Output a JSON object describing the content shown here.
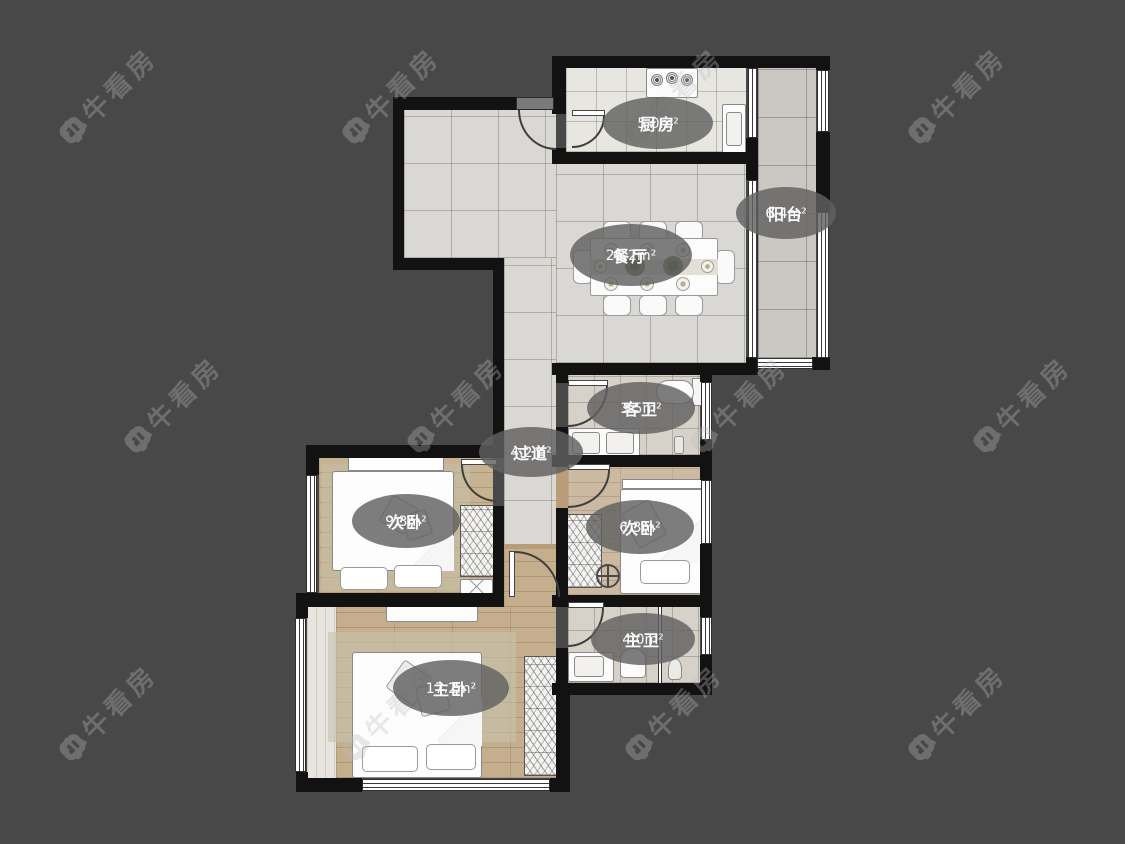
{
  "watermark": {
    "brand": "小牛看房",
    "star_icon": "✦"
  },
  "rooms": [
    {
      "id": "kitchen",
      "name": "厨房",
      "area": "5.0m²"
    },
    {
      "id": "balcony",
      "name": "阳台",
      "area": "6.4m²"
    },
    {
      "id": "dining",
      "name": "餐厅",
      "area": "25.2m²"
    },
    {
      "id": "guest-bath",
      "name": "客卫",
      "area": "3.5m²"
    },
    {
      "id": "hallway",
      "name": "过道",
      "area": "4.2m²"
    },
    {
      "id": "bedroom-left",
      "name": "次卧",
      "area": "9.3m²"
    },
    {
      "id": "bedroom-right",
      "name": "次卧",
      "area": "6.3m²"
    },
    {
      "id": "master-bath",
      "name": "主卫",
      "area": "4.0m²"
    },
    {
      "id": "master-bedroom",
      "name": "主卧",
      "area": "17.2m²"
    }
  ],
  "colors": {
    "background": "#484848",
    "wall": "#121212",
    "tile_floor": "#dad8d4",
    "wood_floor": "#c7b292",
    "label_bubble": "rgba(96,96,96,0.82)",
    "label_text": "#fafafa",
    "watermark": "#bcbcbc"
  }
}
